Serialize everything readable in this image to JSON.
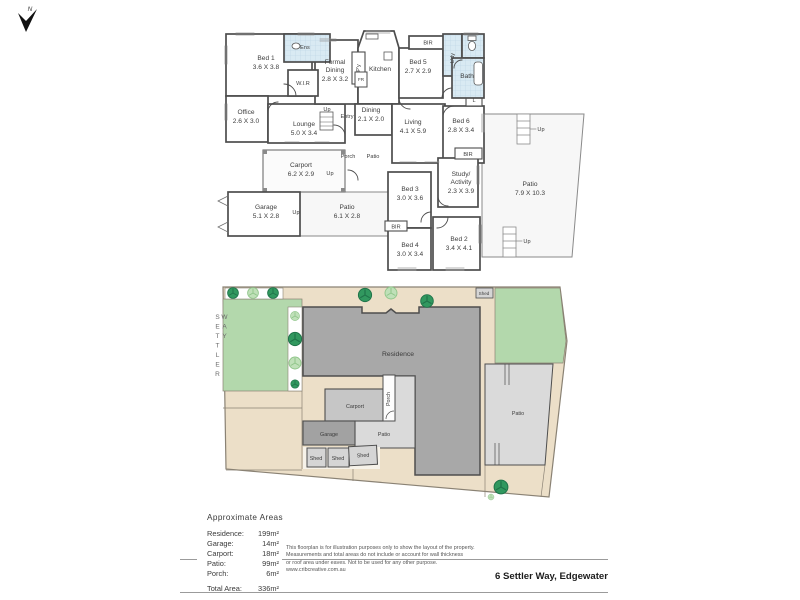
{
  "floorplan": {
    "bed1": {
      "name": "Bed 1",
      "dims": "3.6 X 3.8"
    },
    "ens": "Ens",
    "wir": "W.I.R",
    "office": {
      "name": "Office",
      "dims": "2.6 X 3.0"
    },
    "lounge": {
      "name": "Lounge",
      "dims": "5.0 X 3.4"
    },
    "formal_dining": {
      "l1": "Formal",
      "l2": "Dining",
      "dims": "2.8 X 3.2"
    },
    "pantry": "P'y",
    "kitchen": "Kitchen",
    "fridge": "FR",
    "bed5": {
      "name": "Bed 5",
      "dims": "2.7 X 2.9"
    },
    "bir_top": "BIR",
    "laundry": "L'dy",
    "bath": "Bath",
    "linen": "L",
    "up_entry": "Up",
    "entry": "Entry",
    "dining": {
      "name": "Dining",
      "dims": "2.1 X 2.0"
    },
    "living": {
      "name": "Living",
      "dims": "4.1 X 5.9"
    },
    "bed6": {
      "name": "Bed 6",
      "dims": "2.8 X 3.4"
    },
    "porch": "Porch",
    "patio_small": "Patio",
    "carport": {
      "name": "Carport",
      "dims": "6.2 X 2.9"
    },
    "up_carport": "Up",
    "garage": {
      "name": "Garage",
      "dims": "5.1 X 2.8"
    },
    "up_garage": "Up",
    "patio_mid": {
      "name": "Patio",
      "dims": "6.1 X 2.8"
    },
    "bed3": {
      "name": "Bed 3",
      "dims": "3.0 X 3.6"
    },
    "bir_mid": "BIR",
    "bed4": {
      "name": "Bed 4",
      "dims": "3.0 X 3.4"
    },
    "study": {
      "l1": "Study/",
      "l2": "Activity",
      "dims": "2.3 X 3.9"
    },
    "bed2": {
      "name": "Bed 2",
      "dims": "3.4 X 4.1"
    },
    "bir_right": "BIR",
    "patio_big": {
      "name": "Patio",
      "dims": "7.9 X 10.3"
    },
    "up_patio_top": "Up",
    "up_patio_bottom": "Up"
  },
  "siteplan": {
    "street": "SETTLER WAY",
    "residence": "Residence",
    "carport": "Carport",
    "porch": "Porch",
    "patio_center": "Patio",
    "garage": "Garage",
    "shed1": "Shed",
    "shed2": "Shed",
    "shed3": "Shed",
    "shed_top": "Shed",
    "patio_right": "Patio"
  },
  "areas": {
    "title": "Approximate Areas",
    "rows": [
      {
        "label": "Residence:",
        "value": "199m²"
      },
      {
        "label": "Garage:",
        "value": "14m²"
      },
      {
        "label": "Carport:",
        "value": "18m²"
      },
      {
        "label": "Patio:",
        "value": "99m²"
      },
      {
        "label": "Porch:",
        "value": "6m²"
      }
    ],
    "total_label": "Total Area:",
    "total_value": "336m²"
  },
  "disclaimer": {
    "lines": [
      "This floorplan is for illustration purposes only to show the layout of the property.",
      "Measurements and total areas do not include or account for wall thickness",
      "or roof area under eaves. Not to be used for any other purpose.",
      "www.cribcreative.com.au"
    ]
  },
  "footer": {
    "address": "6 Settler Way, Edgewater",
    "compass": "N"
  },
  "colors": {
    "lawn": "#b3d8ac",
    "ground": "#ecdfc8",
    "residence": "#a8a8a8",
    "carport": "#c6c6c6",
    "patio": "#dadada",
    "tile": "#d9eaf3",
    "wall": "#4d4d4d"
  }
}
